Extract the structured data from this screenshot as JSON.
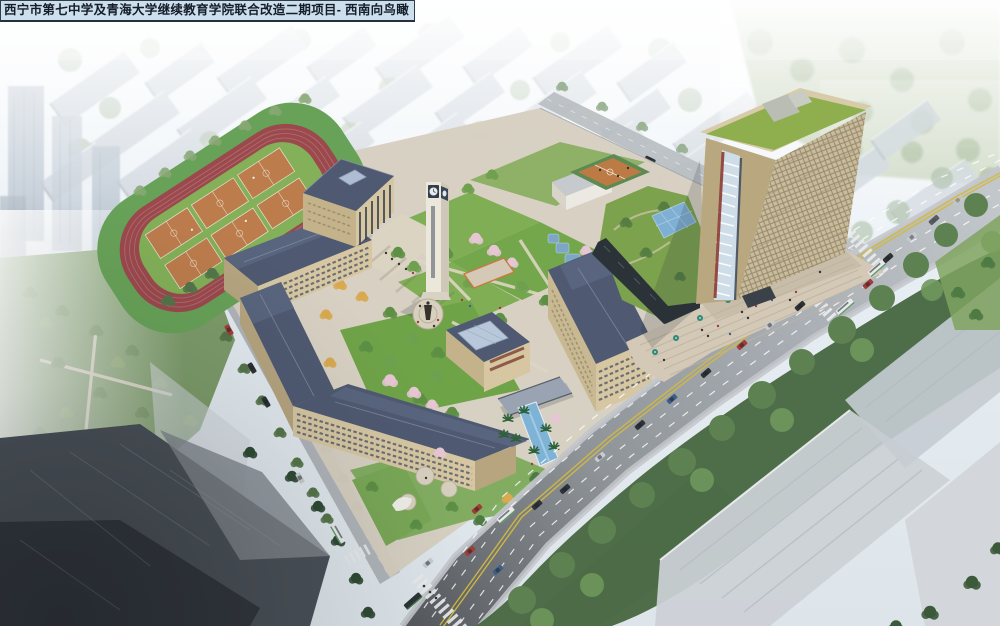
{
  "title_bar": {
    "text": "西宁市第七中学及青海大学继续教育学院联合改造二期项目- 西南向鸟瞰"
  },
  "palette": {
    "fog_sky": "#eef3f8",
    "campus_wall": "#d6c7a2",
    "roof_slate": "#4f5a72",
    "track_red": "#9c494d",
    "court_orange": "#bd7c4c",
    "infield_green": "#83b058",
    "lawn_green": "#7fae55",
    "tree_green": "#5d8f45",
    "blossom_pink": "#e6c6d2",
    "autumn_yellow": "#d8a94e",
    "water_blue": "#7fb3d6",
    "road_grey": "#8f9499",
    "lane_yellow": "#d2b93f",
    "tower_beige": "#c9bb9b",
    "tower_roof_green": "#8fae4e",
    "glass_blue": "#7fb0d4",
    "umbrella_teal": "#2e8a7a"
  },
  "scene_elements": [
    "running-track",
    "basketball-courts",
    "auditorium",
    "clock-tower",
    "classroom-wings",
    "central-courtyard",
    "monument-plaza",
    "entrance-water-canal",
    "highrise-tower",
    "podium-green-roof",
    "glass-pyramid-skylight",
    "entrance-plaza",
    "main-road",
    "crosswalks",
    "city-background",
    "west-park"
  ]
}
